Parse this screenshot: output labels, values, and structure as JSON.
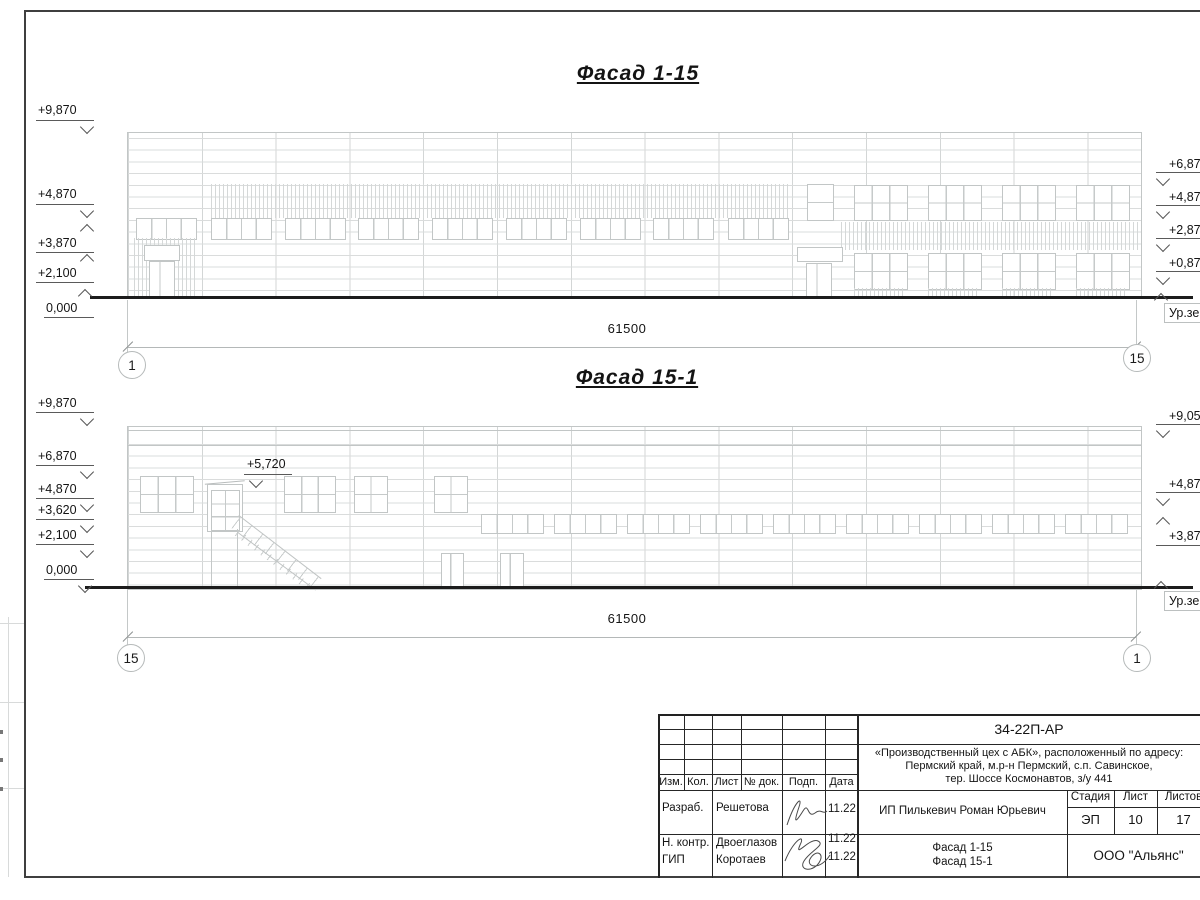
{
  "sheet": {
    "facade_top": {
      "title": "Фасад 1-15",
      "marks_left": [
        "+9,870",
        "+4,870",
        "+3,870",
        "+2,100",
        "0,000"
      ],
      "marks_right": [
        "+6,87",
        "+4,87",
        "+2,87",
        "+0,87"
      ],
      "ground_label": "Ур.зе",
      "dimension": "61500",
      "axis_left": "1",
      "axis_right": "15"
    },
    "facade_bottom": {
      "title": "Фасад 15-1",
      "marks_left": [
        "+9,870",
        "+6,870",
        "+4,870",
        "+3,620",
        "+2,100",
        "0,000"
      ],
      "stair_mark": "+5,720",
      "marks_right": [
        "+9,05",
        "+4,87",
        "+3,87"
      ],
      "ground_label": "Ур.зе",
      "dimension": "61500",
      "axis_left": "15",
      "axis_right": "1"
    },
    "title_block": {
      "code": "34-22П-АР",
      "project": [
        "«Производственный цех с АБК», расположенный по адресу:",
        "Пермский край, м.р-н Пермский, с.п. Савинское,",
        "тер. Шоссе Космонавтов, з/у 441"
      ],
      "header_cols": [
        "Изм.",
        "Кол.",
        "Лист",
        "№ док.",
        "Подп.",
        "Дата"
      ],
      "rows": [
        {
          "role": "Разраб.",
          "name": "Решетова",
          "date": "11.22"
        },
        {
          "role": "Н. контр.",
          "name": "Двоеглазов",
          "date": "11.22"
        },
        {
          "role": "ГИП",
          "name": "Коротаев",
          "date": "11.22"
        }
      ],
      "client": "ИП Пилькевич Роман Юрьевич",
      "stage_label": "Стадия",
      "stage": "ЭП",
      "sheet_label": "Лист",
      "sheet_no": "10",
      "sheets_label": "Листов",
      "sheets_total": "17",
      "drawing_names": [
        "Фасад 1-15",
        "Фасад 15-1"
      ],
      "company": "ООО \"Альянс\""
    }
  }
}
